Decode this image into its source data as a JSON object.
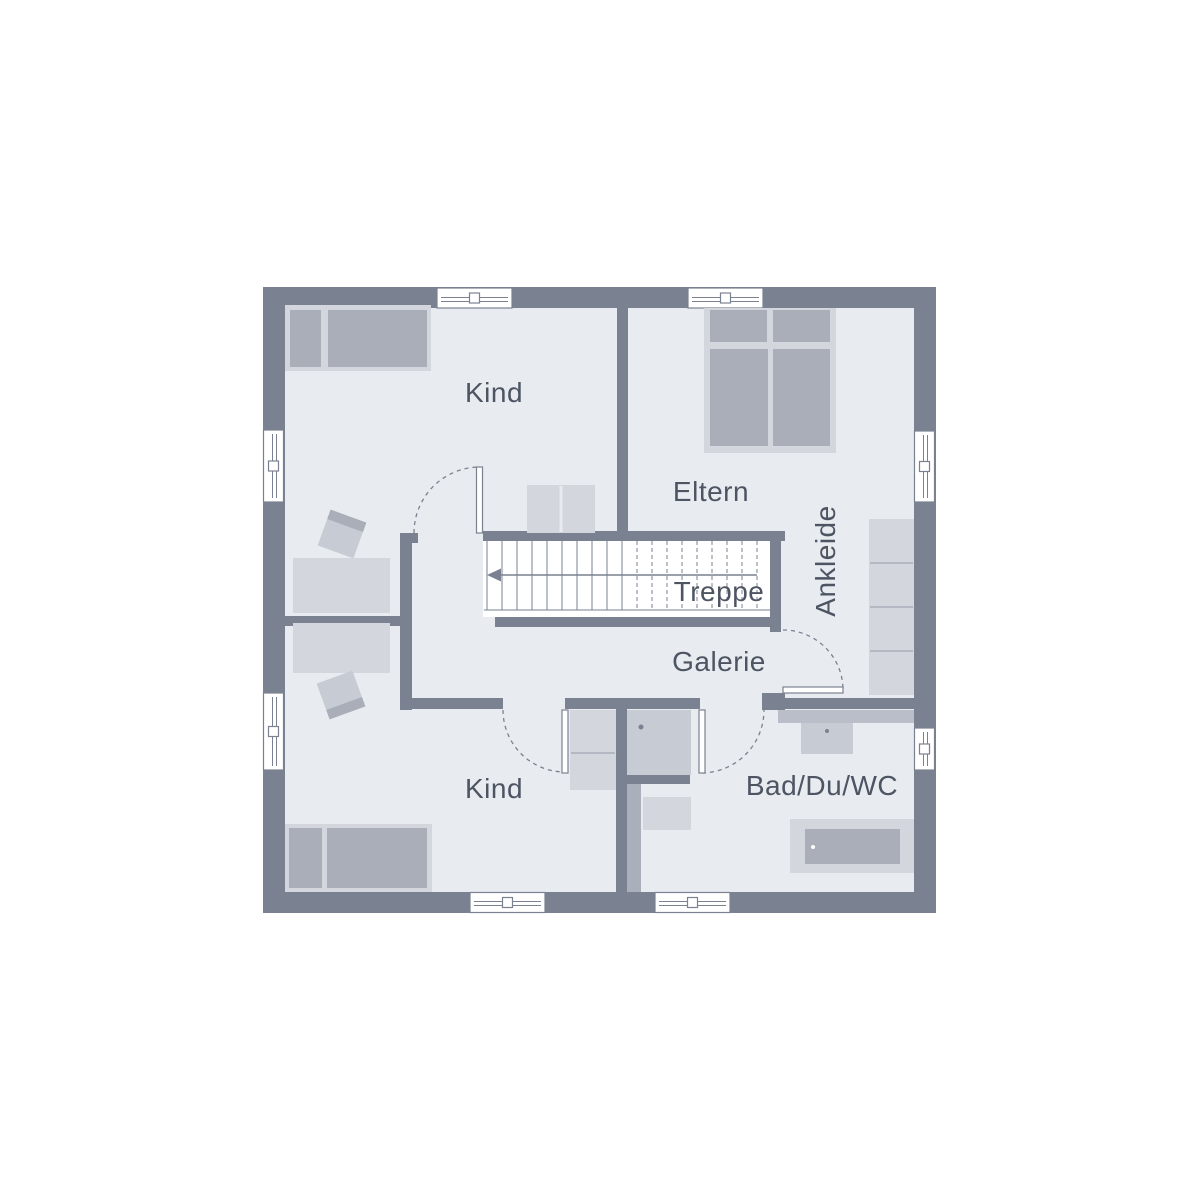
{
  "plan": {
    "rooms": [
      {
        "id": "kind-top",
        "label": "Kind"
      },
      {
        "id": "eltern",
        "label": "Eltern"
      },
      {
        "id": "ankleide",
        "label": "Ankleide"
      },
      {
        "id": "treppe",
        "label": "Treppe"
      },
      {
        "id": "galerie",
        "label": "Galerie"
      },
      {
        "id": "kind-bottom",
        "label": "Kind"
      },
      {
        "id": "bad",
        "label": "Bad/Du/WC"
      }
    ]
  },
  "colors": {
    "wall": "#7a8291",
    "floor": "#e8ebf0",
    "furniture_light": "#d3d6dd",
    "furniture_medium": "#a9aeb9",
    "furniture_accent": "#c6cbd4",
    "counter": "#b9bec8",
    "strip": "#a9afbb",
    "label_text": "#4d5462",
    "line": "#7a8291",
    "white": "#ffffff"
  }
}
